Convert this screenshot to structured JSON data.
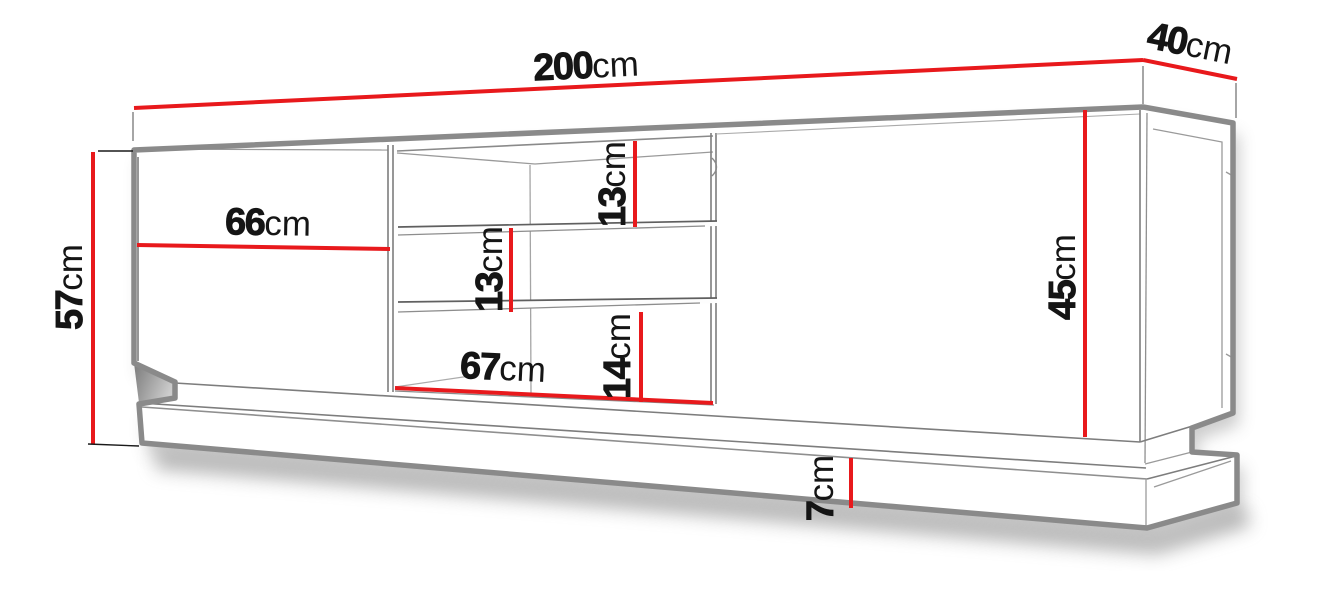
{
  "diagram": {
    "colors": {
      "dimension_line": "#e8191c",
      "outline": "#8a8a8a",
      "label_text": "#151515"
    },
    "dims": {
      "d200": {
        "value": "200",
        "unit": "cm"
      },
      "d40": {
        "value": "40",
        "unit": "cm"
      },
      "d57": {
        "value": "57",
        "unit": "cm"
      },
      "d66": {
        "value": "66",
        "unit": "cm"
      },
      "d45": {
        "value": "45",
        "unit": "cm"
      },
      "d13a": {
        "value": "13",
        "unit": "cm"
      },
      "d13b": {
        "value": "13",
        "unit": "cm"
      },
      "d14": {
        "value": "14",
        "unit": "cm"
      },
      "d67": {
        "value": "67",
        "unit": "cm"
      },
      "d7": {
        "value": "7",
        "unit": "cm"
      }
    }
  }
}
